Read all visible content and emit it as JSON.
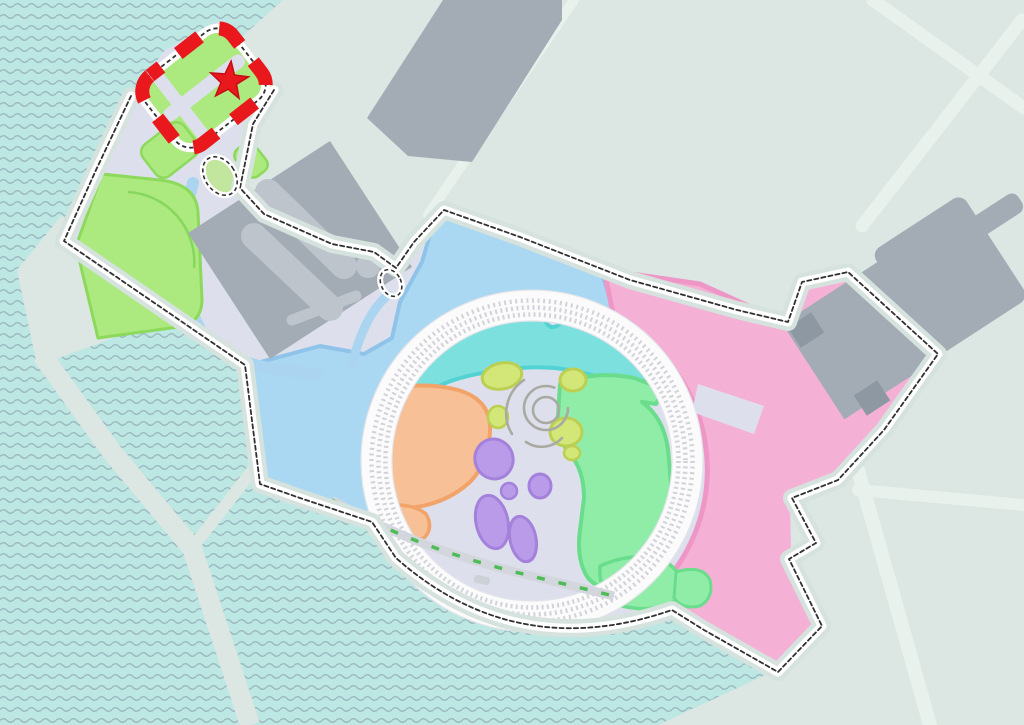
{
  "map": {
    "kind": "theme-park-resort-map",
    "marker": {
      "shape": "star",
      "color": "#e8181d"
    },
    "colors": {
      "background": "#dce6e2",
      "road": "#e9f1ed",
      "water": "#bce7e3",
      "wave": "#9db9bf",
      "park_base": "#dde0ec",
      "shore_band": "#d6e2dd",
      "west_land_fill": "#aad8f3",
      "west_land_edge": "#8fc3e9",
      "east_land_fill": "#f5b0d5",
      "east_land_edge": "#ee97c6",
      "north_zone_fill": "#7be0de",
      "north_zone_edge": "#52d2d3",
      "orange_zone_fill": "#f8c096",
      "orange_zone_edge": "#f2a369",
      "green_zone_fill": "#90eda8",
      "green_zone_edge": "#69dd8b",
      "olive_zone_fill": "#d3e678",
      "olive_zone_edge": "#bccf52",
      "purple_zone_fill": "#b99be9",
      "purple_zone_edge": "#a481da",
      "entrance_green_fill": "#ace97e",
      "entrance_green_edge": "#8cd95c",
      "lawn_arc": "#86d75e",
      "pond_green": "#c2e69e",
      "building": "#a3acb5",
      "building_light": "#bdc4cb",
      "building_dark": "#8e98a2",
      "ring_base": "#fbfbfb",
      "ring_dots": "#d2d3da",
      "ring_edge": "#e3e4ea",
      "boundary_dash": "#303030",
      "boundary_casing": "#ffffff",
      "highlight_red": "#e8181d",
      "highlight_red_dark": "#c50e13",
      "canal": "#abd4f0",
      "dock_band": "#d3d7dd",
      "dock_accent": "#4fbc58",
      "dock_fill": "#ccd1d8",
      "swirl": "#a9aba2"
    },
    "regions": [
      {
        "id": "bay-water",
        "color": "#bce7e3"
      },
      {
        "id": "entrance-highlight",
        "color": "#e8181d"
      },
      {
        "id": "entrance-green-area",
        "color": "#ace97e"
      },
      {
        "id": "west-blue-land",
        "color": "#aad8f3"
      },
      {
        "id": "east-pink-land",
        "color": "#f5b0d5"
      },
      {
        "id": "north-cyan-zone",
        "color": "#7be0de"
      },
      {
        "id": "west-orange-zone",
        "color": "#f8c096"
      },
      {
        "id": "east-green-zone",
        "color": "#90eda8"
      },
      {
        "id": "purple-zone",
        "color": "#b99be9"
      },
      {
        "id": "olive-zone",
        "color": "#d3e678"
      },
      {
        "id": "central-ring",
        "color": "#fbfbfb"
      }
    ]
  }
}
